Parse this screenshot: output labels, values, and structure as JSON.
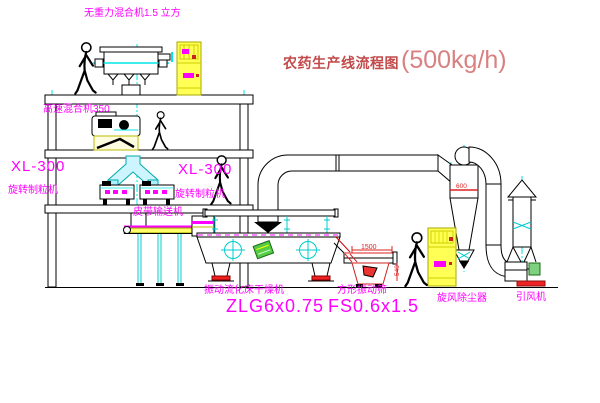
{
  "title": {
    "main": "农药生产线流程图",
    "capacity": "(500kg/h)"
  },
  "labels": {
    "gravity_mixer": "无重力混合机1.5 立方",
    "high_speed_mixer": "高速混合机350",
    "granulator_left_model": "XL-300",
    "granulator_left_name": "旋转制粒机",
    "granulator_right_model": "XL-300",
    "granulator_right_name": "旋转制粒机",
    "belt_conveyor": "皮带输送机",
    "dryer_name": "振动流化床干燥机",
    "dryer_model": "ZLG6x0.75",
    "sieve_name": "方形振动筛",
    "sieve_model": "FS0.6x1.5",
    "cyclone": "旋风除尘器",
    "fan": "引风机"
  },
  "dimensions": {
    "sieve_length": "1500",
    "sieve_height": "540",
    "cyclone_note": "600"
  },
  "colors": {
    "label_magenta": "#ff00ff",
    "title_red": "#c24a4a",
    "capacity_red": "#d98080",
    "centerline_cyan": "#00e5e5",
    "cabinet_yellow": "#ffff55",
    "accent_red": "#ee2222",
    "machine_green": "#55cc44",
    "line_black": "#000000"
  }
}
